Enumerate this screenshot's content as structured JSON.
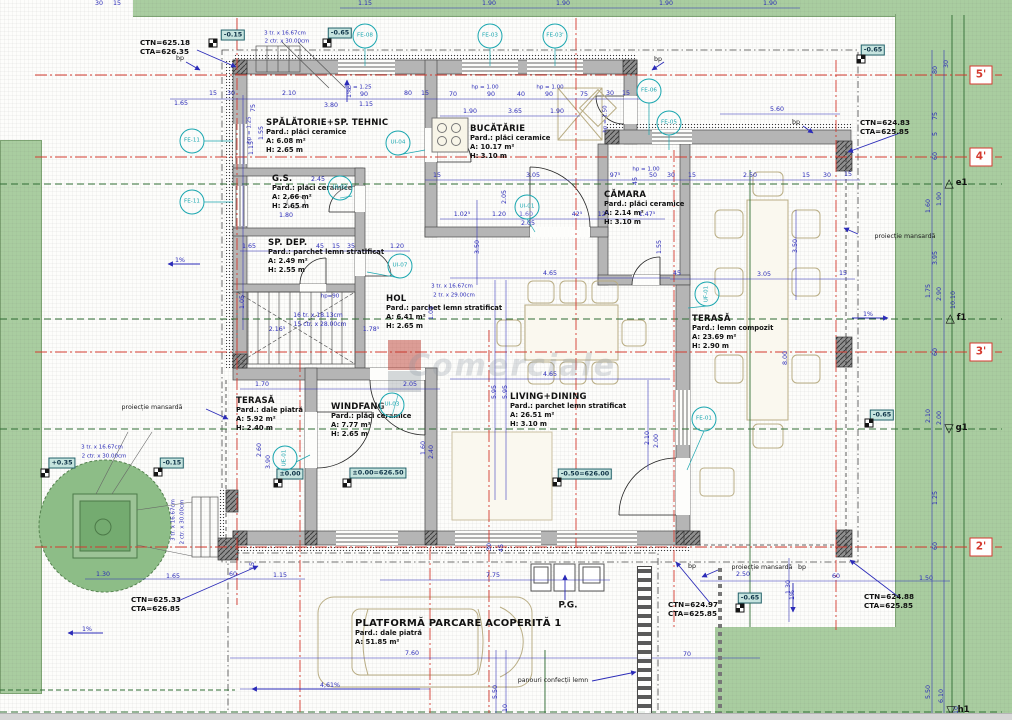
{
  "watermark": {
    "text": "Comerciale"
  },
  "colors": {
    "landscape_green": "#a9cda0",
    "tree_green": "#8dbd87",
    "dim_blue": "#2b2bb8",
    "annotation_teal": "#19a6af",
    "axis_red": "#d43a2f",
    "contour_green": "#2f6d33",
    "wall_gray": "#b5b5b5"
  },
  "rooms": [
    {
      "name": "SPĂLĂTORIE+SP. TEHNIC",
      "floor": "Pard.: plăci ceramice",
      "area": "A: 6.08 m²",
      "height": "H: 2.65 m",
      "x": 266,
      "y": 118
    },
    {
      "name": "BUCĂTĂRIE",
      "floor": "Pard.: plăci ceramice",
      "area": "A: 10.17 m²",
      "height": "H: 3.10 m",
      "x": 470,
      "y": 124
    },
    {
      "name": "G.S.",
      "floor": "Pard.: plăci ceramice",
      "area": "A: 2.66 m²",
      "height": "H: 2.65 m",
      "x": 272,
      "y": 174
    },
    {
      "name": "CĂMARA",
      "floor": "Pard.: plăci ceramice",
      "area": "A: 2.14 m²",
      "height": "H: 3.10 m",
      "x": 604,
      "y": 190
    },
    {
      "name": "SP. DEP.",
      "floor": "Pard.: parchet lemn stratificat",
      "area": "A: 2.49 m²",
      "height": "H: 2.55 m",
      "x": 268,
      "y": 238
    },
    {
      "name": "HOL",
      "floor": "Pard.: parchet lemn stratificat",
      "area": "A: 6.41 m²",
      "height": "H: 2.65 m",
      "x": 386,
      "y": 294
    },
    {
      "name": "TERASĂ",
      "floor": "Pard.: lemn compozit",
      "area": "A: 23.69 m²",
      "height": "H: 2.90 m",
      "x": 692,
      "y": 314
    },
    {
      "name": "TERASĂ",
      "floor": "Pard.: dale piatră",
      "area": "A: 5.92 m²",
      "height": "H: 2.40 m",
      "x": 236,
      "y": 396
    },
    {
      "name": "WINDFANG",
      "floor": "Pard.: plăci ceramice",
      "area": "A: 7.77 m²",
      "height": "H: 2.65 m",
      "x": 331,
      "y": 402
    },
    {
      "name": "LIVING+DINING",
      "floor": "Pard.: parchet lemn stratificat",
      "area": "A: 26.51 m²",
      "height": "H: 3.10 m",
      "x": 510,
      "y": 392
    },
    {
      "name": "PLATFORMĂ PARCARE ACOPERITĂ 1",
      "floor": "Pard.: dale piatră",
      "area": "A: 51.85 m²",
      "height": "",
      "x": 355,
      "y": 618
    }
  ],
  "detail_circles": [
    {
      "label": "FE-08",
      "x": 365,
      "y": 36
    },
    {
      "label": "FE-03",
      "x": 490,
      "y": 36
    },
    {
      "label": "FE-03'",
      "x": 555,
      "y": 36
    },
    {
      "label": "FE-06",
      "x": 649,
      "y": 91
    },
    {
      "label": "FE-05",
      "x": 669,
      "y": 123
    },
    {
      "label": "FE-11",
      "x": 192,
      "y": 141
    },
    {
      "label": "FE-11",
      "x": 192,
      "y": 202
    },
    {
      "label": "UI-04",
      "x": 398,
      "y": 143
    },
    {
      "label": "UI-02",
      "x": 340,
      "y": 188
    },
    {
      "label": "UI-01",
      "x": 527,
      "y": 207
    },
    {
      "label": "UI-07",
      "x": 400,
      "y": 266
    },
    {
      "label": "UF-01",
      "x": 707,
      "y": 294,
      "r": 1
    },
    {
      "label": "UI-03",
      "x": 392,
      "y": 405
    },
    {
      "label": "UE-01",
      "x": 285,
      "y": 458,
      "r": 1
    },
    {
      "label": "FE-01",
      "x": 704,
      "y": 419
    }
  ],
  "elevation_badges": [
    {
      "t": "-0.15",
      "x": 233,
      "y": 35
    },
    {
      "t": "-0.65",
      "x": 340,
      "y": 33
    },
    {
      "t": "-0.65",
      "x": 873,
      "y": 50
    },
    {
      "t": "+0.35",
      "x": 62,
      "y": 463
    },
    {
      "t": "-0.15",
      "x": 172,
      "y": 463
    },
    {
      "t": "-0.65",
      "x": 882,
      "y": 415
    },
    {
      "t": "-0.65",
      "x": 750,
      "y": 598
    },
    {
      "t": "±0.00",
      "x": 290,
      "y": 474
    },
    {
      "t": "±0.00=626.50",
      "x": 378,
      "y": 473
    },
    {
      "t": "-0.50=626.00",
      "x": 585,
      "y": 474
    }
  ],
  "point_markers": [
    {
      "x": 213,
      "y": 43
    },
    {
      "x": 327,
      "y": 43
    },
    {
      "x": 861,
      "y": 59
    },
    {
      "x": 45,
      "y": 473
    },
    {
      "x": 158,
      "y": 472
    },
    {
      "x": 869,
      "y": 423
    },
    {
      "x": 740,
      "y": 608
    },
    {
      "x": 278,
      "y": 483
    },
    {
      "x": 347,
      "y": 483
    },
    {
      "x": 557,
      "y": 482
    }
  ],
  "level_labels": [
    {
      "l1": "CTN=625.18",
      "l2": "CTA=626.35",
      "x": 140,
      "y": 38
    },
    {
      "l1": "CTN=624.83",
      "l2": "CTA=625.85",
      "x": 860,
      "y": 118
    },
    {
      "l1": "CTN=625.33",
      "l2": "CTA=626.85",
      "x": 131,
      "y": 595
    },
    {
      "l1": "CTN=624.97",
      "l2": "CTA=625.85",
      "x": 668,
      "y": 600
    },
    {
      "l1": "CTN=624.88",
      "l2": "CTA=625.85",
      "x": 864,
      "y": 592
    }
  ],
  "axis_boxes": [
    {
      "t": "5'",
      "x": 981,
      "y": 75
    },
    {
      "t": "4'",
      "x": 981,
      "y": 157
    },
    {
      "t": "3'",
      "x": 981,
      "y": 352
    },
    {
      "t": "2'",
      "x": 981,
      "y": 547
    }
  ],
  "axis_triangles": [
    {
      "t": "e1",
      "x": 956,
      "y": 183,
      "dir": "up"
    },
    {
      "t": "f1",
      "x": 956,
      "y": 318,
      "dir": "up"
    },
    {
      "t": "g1",
      "x": 956,
      "y": 428,
      "dir": "down"
    },
    {
      "t": "h1",
      "x": 958,
      "y": 710,
      "dir": "down"
    }
  ],
  "notes": [
    {
      "t": "bp",
      "x": 180,
      "y": 59
    },
    {
      "t": "bp",
      "x": 658,
      "y": 60
    },
    {
      "t": "bp",
      "x": 796,
      "y": 123
    },
    {
      "t": "bp",
      "x": 692,
      "y": 567
    },
    {
      "t": "bp",
      "x": 802,
      "y": 568
    },
    {
      "t": "proiecție mansardă",
      "x": 905,
      "y": 237
    },
    {
      "t": "proiecție mansardă",
      "x": 152,
      "y": 408
    },
    {
      "t": "proiecție mansardă",
      "x": 762,
      "y": 568
    },
    {
      "t": "P.G.",
      "x": 568,
      "y": 606,
      "w": 1,
      "s": 9
    },
    {
      "t": "panouri confecții lemn",
      "x": 553,
      "y": 681
    },
    {
      "t": "4,61%",
      "x": 330,
      "y": 686,
      "c": "b"
    },
    {
      "t": "1%",
      "x": 350,
      "y": 93,
      "r": 1,
      "c": "b"
    },
    {
      "t": "1%",
      "x": 180,
      "y": 261,
      "c": "b"
    },
    {
      "t": "1%",
      "x": 868,
      "y": 315,
      "c": "b"
    },
    {
      "t": "1%",
      "x": 793,
      "y": 595,
      "r": 1,
      "c": "b"
    },
    {
      "t": "1%",
      "x": 87,
      "y": 630,
      "c": "b"
    },
    {
      "t": "hp = 1.25",
      "x": 358,
      "y": 88,
      "c": "b",
      "s": 5.5
    },
    {
      "t": "hp = 1.00",
      "x": 485,
      "y": 88,
      "c": "b",
      "s": 5.5
    },
    {
      "t": "hp = 1.00",
      "x": 550,
      "y": 88,
      "c": "b",
      "s": 5.5
    },
    {
      "t": "hp = 1.00",
      "x": 646,
      "y": 170,
      "c": "b",
      "s": 5.5
    },
    {
      "t": "hp = 1.25",
      "x": 250,
      "y": 130,
      "r": 1,
      "c": "b",
      "s": 5.5
    },
    {
      "t": "hp = 1.50",
      "x": 606,
      "y": 119,
      "r": 1,
      "c": "b",
      "s": 5.5
    },
    {
      "t": "hp=90",
      "x": 330,
      "y": 297,
      "c": "b",
      "s": 5.5
    },
    {
      "t": "3 tr. x 16.67cm",
      "x": 285,
      "y": 34,
      "c": "b",
      "s": 5.5
    },
    {
      "t": "2 ctr. x 30.00cm",
      "x": 287,
      "y": 42,
      "c": "b",
      "s": 5.5
    },
    {
      "t": "16 tr. x 18.13cm",
      "x": 318,
      "y": 316,
      "c": "b",
      "s": 6
    },
    {
      "t": "15 ctr. x 28.00cm",
      "x": 320,
      "y": 325,
      "c": "b",
      "s": 6
    },
    {
      "t": "3 tr. x 16.67cm",
      "x": 452,
      "y": 287,
      "c": "b",
      "s": 5.5
    },
    {
      "t": "2 tr. x 29.00cm",
      "x": 454,
      "y": 296,
      "c": "b",
      "s": 5.5
    },
    {
      "t": "3 tr. x 16.67cm",
      "x": 102,
      "y": 448,
      "c": "b",
      "s": 5.5
    },
    {
      "t": "2 ctr. x 30.00cm",
      "x": 104,
      "y": 457,
      "c": "b",
      "s": 5.5
    },
    {
      "t": "3 tr. x 16.67cm",
      "x": 174,
      "y": 520,
      "r": 1,
      "c": "b",
      "s": 5.5
    },
    {
      "t": "2 ctr. x 30.00cm",
      "x": 183,
      "y": 522,
      "r": 1,
      "c": "b",
      "s": 5.5
    }
  ],
  "dimensions": [
    {
      "t": "30",
      "x": 99,
      "y": 4
    },
    {
      "t": "15",
      "x": 117,
      "y": 4
    },
    {
      "t": "1.15",
      "x": 365,
      "y": 4
    },
    {
      "t": "1.90",
      "x": 489,
      "y": 4
    },
    {
      "t": "1.90",
      "x": 563,
      "y": 4
    },
    {
      "t": "1.90",
      "x": 666,
      "y": 4
    },
    {
      "t": "1.90",
      "x": 770,
      "y": 4
    },
    {
      "t": "1.65",
      "x": 181,
      "y": 104
    },
    {
      "t": "15",
      "x": 213,
      "y": 94
    },
    {
      "t": "30",
      "x": 231,
      "y": 94
    },
    {
      "t": "75",
      "x": 254,
      "y": 108,
      "r": 1
    },
    {
      "t": "2.10",
      "x": 289,
      "y": 94
    },
    {
      "t": "3.80",
      "x": 331,
      "y": 106
    },
    {
      "t": "90",
      "x": 364,
      "y": 95
    },
    {
      "t": "1.15",
      "x": 366,
      "y": 105
    },
    {
      "t": "80",
      "x": 408,
      "y": 94
    },
    {
      "t": "15",
      "x": 425,
      "y": 94
    },
    {
      "t": "70",
      "x": 453,
      "y": 95
    },
    {
      "t": "90",
      "x": 491,
      "y": 95
    },
    {
      "t": "40",
      "x": 521,
      "y": 95
    },
    {
      "t": "90",
      "x": 549,
      "y": 95
    },
    {
      "t": "75",
      "x": 584,
      "y": 95
    },
    {
      "t": "30",
      "x": 610,
      "y": 94
    },
    {
      "t": "15",
      "x": 626,
      "y": 94
    },
    {
      "t": "5.60",
      "x": 777,
      "y": 110
    },
    {
      "t": "1.90",
      "x": 470,
      "y": 112
    },
    {
      "t": "3.65",
      "x": 515,
      "y": 112
    },
    {
      "t": "1.90",
      "x": 557,
      "y": 112
    },
    {
      "t": "1.55",
      "x": 262,
      "y": 133,
      "r": 1
    },
    {
      "t": "1.15",
      "x": 252,
      "y": 148,
      "r": 1
    },
    {
      "t": "2.45",
      "x": 318,
      "y": 180
    },
    {
      "t": "1.80",
      "x": 286,
      "y": 216
    },
    {
      "t": "15",
      "x": 437,
      "y": 176
    },
    {
      "t": "3.05",
      "x": 533,
      "y": 176
    },
    {
      "t": "97⁵",
      "x": 615,
      "y": 176
    },
    {
      "t": "45",
      "x": 636,
      "y": 181,
      "r": 1
    },
    {
      "t": "50",
      "x": 653,
      "y": 176
    },
    {
      "t": "30",
      "x": 671,
      "y": 176
    },
    {
      "t": "15",
      "x": 692,
      "y": 176
    },
    {
      "t": "2.50",
      "x": 750,
      "y": 176
    },
    {
      "t": "15",
      "x": 806,
      "y": 176
    },
    {
      "t": "30",
      "x": 827,
      "y": 176
    },
    {
      "t": "15",
      "x": 848,
      "y": 175
    },
    {
      "t": "1.02⁵",
      "x": 462,
      "y": 215
    },
    {
      "t": "1.20",
      "x": 499,
      "y": 215
    },
    {
      "t": "1.60",
      "x": 526,
      "y": 215
    },
    {
      "t": "42⁵",
      "x": 577,
      "y": 215
    },
    {
      "t": "12⁵",
      "x": 603,
      "y": 215
    },
    {
      "t": "1.47⁵",
      "x": 647,
      "y": 215
    },
    {
      "t": "2.05",
      "x": 528,
      "y": 224
    },
    {
      "t": "2.05",
      "x": 505,
      "y": 197,
      "r": 1
    },
    {
      "t": "3.50",
      "x": 478,
      "y": 247,
      "r": 1
    },
    {
      "t": "1.55",
      "x": 660,
      "y": 247,
      "r": 1
    },
    {
      "t": "1.65",
      "x": 249,
      "y": 247
    },
    {
      "t": "45",
      "x": 320,
      "y": 247
    },
    {
      "t": "15",
      "x": 336,
      "y": 247
    },
    {
      "t": "35",
      "x": 351,
      "y": 247
    },
    {
      "t": "1.20",
      "x": 397,
      "y": 247
    },
    {
      "t": "1.05",
      "x": 243,
      "y": 302,
      "r": 1
    },
    {
      "t": "1.05",
      "x": 432,
      "y": 313,
      "r": 1
    },
    {
      "t": "2.16⁵",
      "x": 277,
      "y": 330
    },
    {
      "t": "1.78⁵",
      "x": 371,
      "y": 330
    },
    {
      "t": "1.70",
      "x": 262,
      "y": 385
    },
    {
      "t": "2.05",
      "x": 410,
      "y": 385
    },
    {
      "t": "4.65",
      "x": 550,
      "y": 274
    },
    {
      "t": "4.65",
      "x": 550,
      "y": 375
    },
    {
      "t": "5.95",
      "x": 495,
      "y": 392,
      "r": 1
    },
    {
      "t": "5.95",
      "x": 506,
      "y": 392,
      "r": 1
    },
    {
      "t": "2.60",
      "x": 260,
      "y": 450,
      "r": 1
    },
    {
      "t": "3.90",
      "x": 269,
      "y": 462,
      "r": 1
    },
    {
      "t": "1.60",
      "x": 424,
      "y": 448,
      "r": 1
    },
    {
      "t": "2.40",
      "x": 432,
      "y": 452,
      "r": 1
    },
    {
      "t": "2.10",
      "x": 648,
      "y": 438,
      "r": 1
    },
    {
      "t": "2.00",
      "x": 657,
      "y": 441,
      "r": 1
    },
    {
      "t": "3.05",
      "x": 764,
      "y": 275
    },
    {
      "t": "45",
      "x": 677,
      "y": 274
    },
    {
      "t": "15",
      "x": 843,
      "y": 274
    },
    {
      "t": "3.50",
      "x": 796,
      "y": 246,
      "r": 1
    },
    {
      "t": "8.00",
      "x": 786,
      "y": 358,
      "r": 1
    },
    {
      "t": "80",
      "x": 936,
      "y": 70,
      "r": 1
    },
    {
      "t": "30",
      "x": 947,
      "y": 64,
      "r": 1
    },
    {
      "t": "75",
      "x": 936,
      "y": 116,
      "r": 1
    },
    {
      "t": "5",
      "x": 936,
      "y": 134,
      "r": 1
    },
    {
      "t": "60",
      "x": 936,
      "y": 156,
      "r": 1
    },
    {
      "t": "1.90",
      "x": 940,
      "y": 199,
      "r": 1
    },
    {
      "t": "1.60",
      "x": 929,
      "y": 206,
      "r": 1
    },
    {
      "t": "3.95",
      "x": 936,
      "y": 258,
      "r": 1
    },
    {
      "t": "1.75",
      "x": 929,
      "y": 291,
      "r": 1
    },
    {
      "t": "2.90",
      "x": 940,
      "y": 294,
      "r": 1
    },
    {
      "t": "10.10",
      "x": 954,
      "y": 300,
      "r": 1
    },
    {
      "t": "60",
      "x": 936,
      "y": 352,
      "r": 1
    },
    {
      "t": "2.10",
      "x": 929,
      "y": 416,
      "r": 1
    },
    {
      "t": "2.00",
      "x": 940,
      "y": 418,
      "r": 1
    },
    {
      "t": "1.25",
      "x": 936,
      "y": 498,
      "r": 1
    },
    {
      "t": "60",
      "x": 936,
      "y": 546,
      "r": 1
    },
    {
      "t": "5.50",
      "x": 929,
      "y": 692,
      "r": 1
    },
    {
      "t": "6.10",
      "x": 942,
      "y": 696,
      "r": 1
    },
    {
      "t": "10",
      "x": 957,
      "y": 710,
      "r": 1
    },
    {
      "t": "1.30",
      "x": 103,
      "y": 575
    },
    {
      "t": "1.65",
      "x": 173,
      "y": 577
    },
    {
      "t": "60",
      "x": 233,
      "y": 575
    },
    {
      "t": "1.15",
      "x": 280,
      "y": 576
    },
    {
      "t": "15",
      "x": 253,
      "y": 566,
      "r": 1
    },
    {
      "t": "30",
      "x": 490,
      "y": 547,
      "r": 1
    },
    {
      "t": "45",
      "x": 502,
      "y": 548,
      "r": 1
    },
    {
      "t": "7.75",
      "x": 493,
      "y": 576
    },
    {
      "t": "7.60",
      "x": 412,
      "y": 654
    },
    {
      "t": "70",
      "x": 687,
      "y": 655
    },
    {
      "t": "5.50",
      "x": 496,
      "y": 692,
      "r": 1
    },
    {
      "t": "10",
      "x": 506,
      "y": 708,
      "r": 1
    },
    {
      "t": "2.50",
      "x": 743,
      "y": 575
    },
    {
      "t": "1.30",
      "x": 789,
      "y": 587,
      "r": 1
    },
    {
      "t": "60",
      "x": 836,
      "y": 577
    },
    {
      "t": "1.50",
      "x": 926,
      "y": 579
    }
  ]
}
